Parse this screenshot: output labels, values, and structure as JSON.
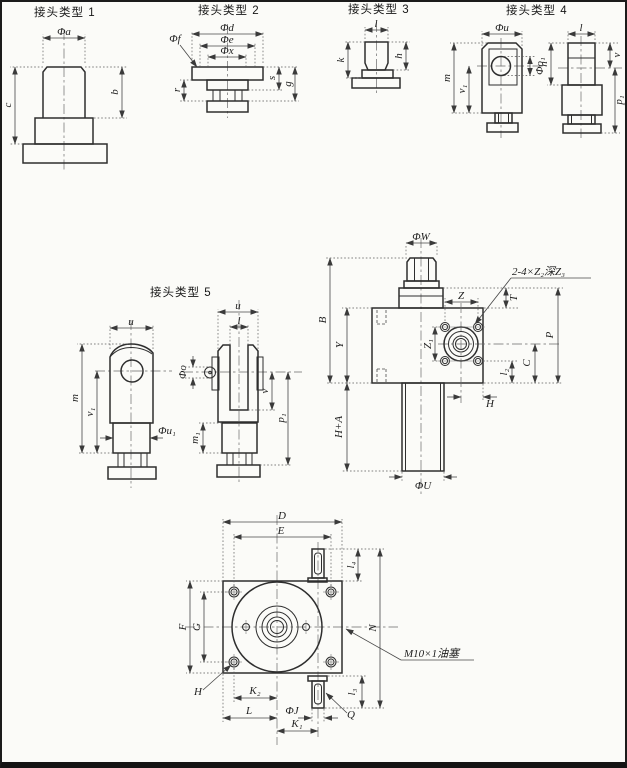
{
  "drawing": {
    "type1": {
      "title": "接头类型 1",
      "dia_a": "Φa",
      "b": "b",
      "c": "c"
    },
    "type2": {
      "title": "接头类型 2",
      "dia_d": "Φd",
      "dia_e": "Φe",
      "dia_x": "Φx",
      "dia_f": "Φf",
      "s": "s",
      "g": "g",
      "r": "r"
    },
    "type3": {
      "title": "接头类型 3",
      "l": "l",
      "h": "h",
      "k": "k"
    },
    "type4": {
      "title": "接头类型 4",
      "dia_u": "Φu",
      "dia_o1": "Φo₁",
      "m": "m",
      "v1": "v₁",
      "l": "l",
      "n": "n",
      "v": "v",
      "p1": "p₁"
    },
    "type5": {
      "title": "接头类型 5",
      "u": "u",
      "m": "m",
      "v1": "v₁",
      "dia_u1": "Φu₁",
      "u2": "u",
      "l": "l",
      "dia_o": "Φo",
      "v": "v",
      "p1": "p₁",
      "m1": "m₁"
    },
    "assembly": {
      "dia_w": "ΦW",
      "b": "B",
      "y": "Y",
      "h_plus_a": "H+A",
      "dia_u_lower": "ΦU",
      "z": "Z",
      "z1": "Z₁",
      "tap_note": "2-4×Z₂深Z₃",
      "t": "T",
      "p": "P",
      "c": "C",
      "l2": "l₂",
      "h": "H"
    },
    "base": {
      "d": "D",
      "e": "E",
      "l4": "l₄",
      "n": "N",
      "l3": "l₃",
      "f": "F",
      "g": "G",
      "h": "H",
      "k2": "K₂",
      "l": "L",
      "dia_j": "ΦJ",
      "k1": "K₁",
      "q": "Q",
      "oil_plug": "M10×1油塞"
    }
  }
}
